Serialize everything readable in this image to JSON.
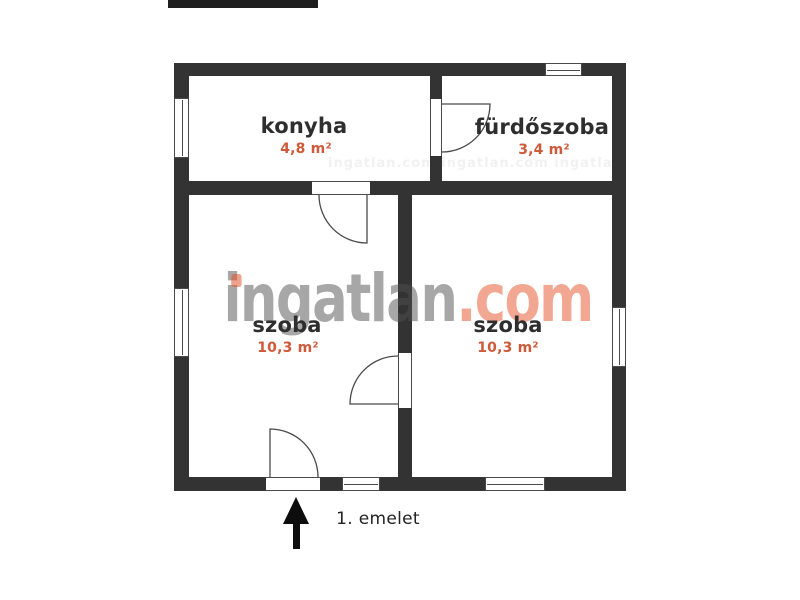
{
  "title": "floor plan",
  "rooms": [
    {
      "name": "konyha",
      "area": "4,8 m²"
    },
    {
      "name": "fürdőszoba",
      "area": "3,4 m²"
    },
    {
      "name": "szoba",
      "area": "10,3 m²"
    },
    {
      "name": "szoba",
      "area": "10,3 m²"
    }
  ],
  "floor_label": "1. emelet",
  "watermark": {
    "name_part": "ingatlan",
    "tld_part": ".com",
    "tile_text": "ingatlan.com  ingatlan.com  ingatlan.com  ingatlan.com"
  },
  "icons": {
    "entrance_arrow": "arrow-up"
  },
  "colors": {
    "wall": "#333333",
    "text": "#2e2e2e",
    "accent": "#cf5a39",
    "watermark_gray": "#9a9a9a",
    "watermark_orange": "#f0a38c"
  }
}
